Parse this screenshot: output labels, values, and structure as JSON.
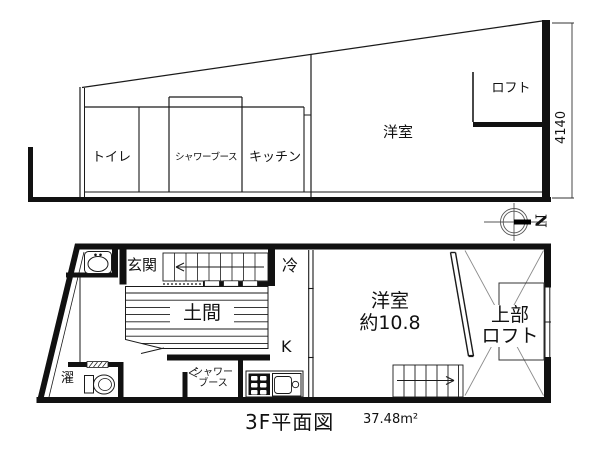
{
  "floorplan": {
    "caption": {
      "title": "3F平面図",
      "area": "37.48m²"
    },
    "compass": {
      "label": "N"
    },
    "section": {
      "toilet": "トイレ",
      "shower_booth": "シャワーブース",
      "kitchen": "キッチン",
      "western_room": "洋室",
      "loft": "ロフト",
      "dimension": "4140"
    },
    "plan": {
      "entrance": "玄関",
      "refrigerator": "冷",
      "doma": "土間",
      "kitchen_k": "K",
      "laundry": "濯",
      "shower_line1": "シャワー",
      "shower_line2": "ブース",
      "room_line1": "洋室",
      "room_line2": "約10.8",
      "upper_loft_line1": "上部",
      "upper_loft_line2": "ロフト"
    }
  }
}
